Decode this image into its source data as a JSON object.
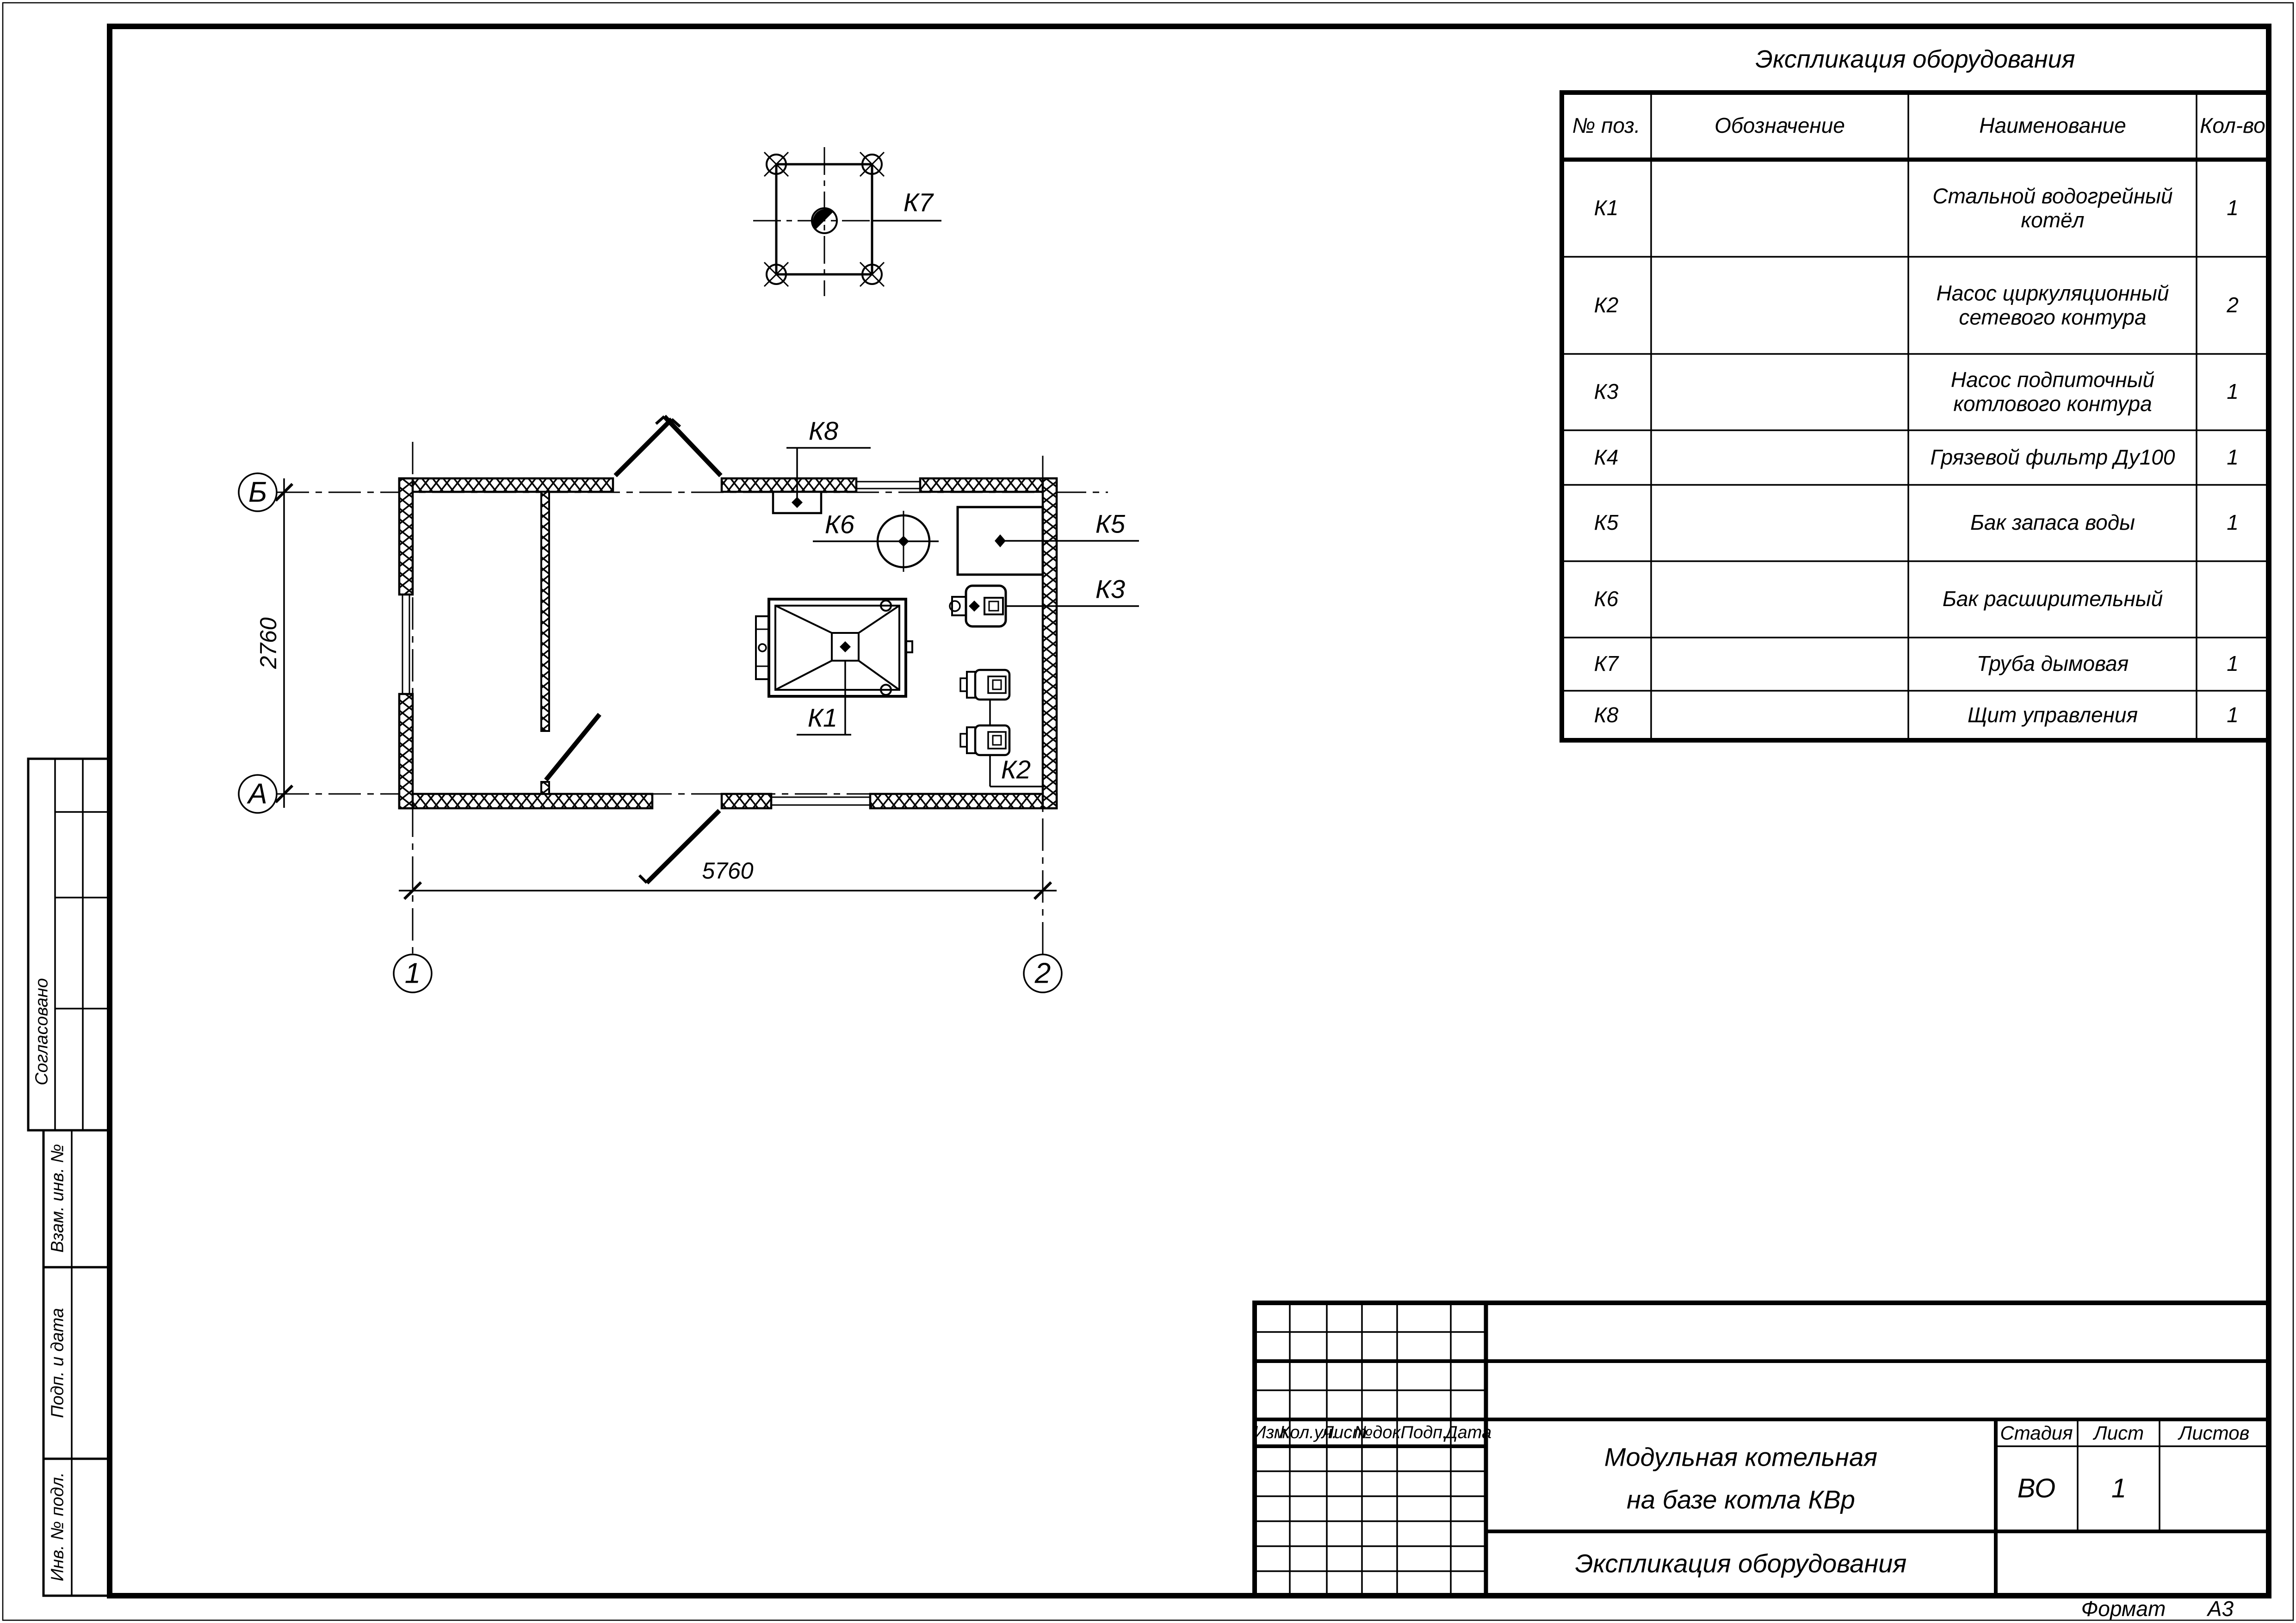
{
  "sheet": {
    "format_note_label": "Формат",
    "format_note_value": "А3"
  },
  "equipment_table": {
    "title": "Экспликация оборудования",
    "columns": {
      "pos": "№ поз.",
      "designation": "Обозначение",
      "name": "Наименование",
      "qty": "Кол-во"
    },
    "rows": [
      {
        "pos": "К1",
        "designation": "",
        "name": "Стальной водогрейный котёл",
        "qty": "1"
      },
      {
        "pos": "К2",
        "designation": "",
        "name": "Насос циркуляционный сетевого контура",
        "qty": "2"
      },
      {
        "pos": "К3",
        "designation": "",
        "name": "Насос подпиточный котлового контура",
        "qty": "1"
      },
      {
        "pos": "К4",
        "designation": "",
        "name": "Грязевой фильтр Ду100",
        "qty": "1"
      },
      {
        "pos": "К5",
        "designation": "",
        "name": "Бак запаса воды",
        "qty": "1"
      },
      {
        "pos": "К6",
        "designation": "",
        "name": "Бак расширительный",
        "qty": ""
      },
      {
        "pos": "К7",
        "designation": "",
        "name": "Труба дымовая",
        "qty": "1"
      },
      {
        "pos": "К8",
        "designation": "",
        "name": "Щит управления",
        "qty": "1"
      }
    ]
  },
  "plan": {
    "axes": {
      "row_top": "Б",
      "row_bottom": "А",
      "col_left": "1",
      "col_right": "2"
    },
    "dimensions": {
      "width_mm": "5760",
      "height_mm": "2760"
    },
    "equipment_labels": {
      "boiler": "К1",
      "pumps_network": "К2",
      "pump_makeup": "К3",
      "tank_water": "К5",
      "tank_expansion": "К6",
      "chimney": "К7",
      "control_panel": "К8"
    }
  },
  "title_block": {
    "revision_headers": [
      "Изм.",
      "Кол.уч.",
      "Лист",
      "№док.",
      "Подп.",
      "Дата"
    ],
    "project_name_line1": "Модульная котельная",
    "project_name_line2": "на базе котла КВр",
    "sheet_title": "Экспликация оборудования",
    "stage_label": "Стадия",
    "sheet_label": "Лист",
    "sheets_label": "Листов",
    "stage_value": "ВО",
    "sheet_number": "1",
    "sheets_value": ""
  },
  "side_strip": {
    "approved": "Согласовано",
    "replacement_inv": "Взам. инв. №",
    "sign_date": "Подп. и дата",
    "inv_original": "Инв. № подл."
  }
}
